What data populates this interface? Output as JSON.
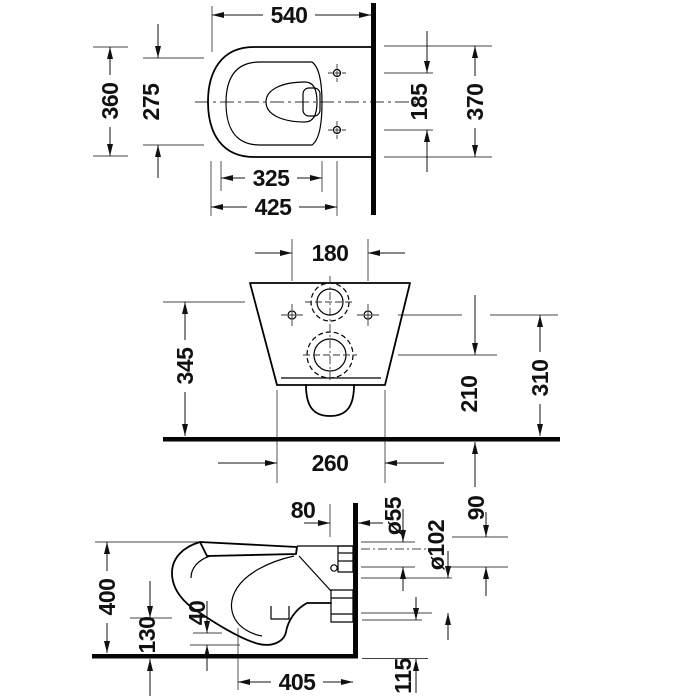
{
  "drawing": {
    "kind": "wall-hung toilet installation dimensions",
    "units": "mm",
    "background": "#ffffff",
    "line_color": "#111111",
    "views": {
      "top": {
        "overall_depth": "540",
        "overall_width": "360",
        "seat_width": "275",
        "dim_325": "325",
        "dim_425": "425",
        "fixing_span": "185",
        "wall_width": "370"
      },
      "rear": {
        "fixing_holes_span": "180",
        "inlet_height": "345",
        "outlet_height": "210",
        "side_fixing_height": "310",
        "base_width": "260"
      },
      "side": {
        "dim_80": "80",
        "inlet_dia": "ø55",
        "outlet_dia": "ø102",
        "dim_90": "90",
        "overall_height": "400",
        "dim_130": "130",
        "dim_40": "40",
        "overall_depth": "405",
        "dim_115": "115"
      }
    }
  }
}
